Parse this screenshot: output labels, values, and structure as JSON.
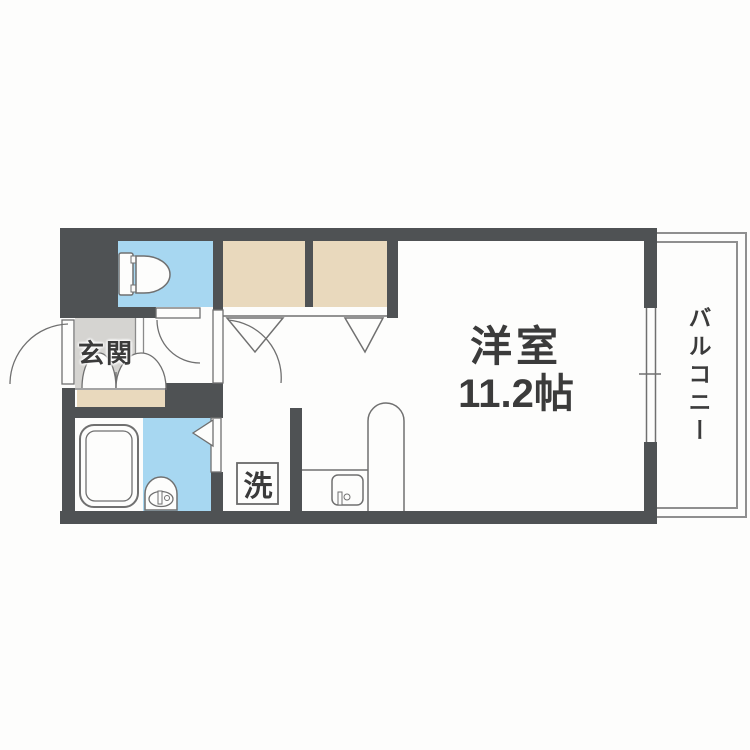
{
  "floorplan": {
    "type": "japanese-apartment-floor-plan",
    "labels": {
      "entrance": "玄関",
      "main_room_name": "洋室",
      "main_room_size": "11.2帖",
      "balcony": "バルコニー",
      "laundry": "洗"
    },
    "colors": {
      "wall": "#4f5254",
      "water_rooms": "#a7d7f1",
      "closet": "#e9d9bd",
      "entrance_floor": "#d5d4d1",
      "outline": "#707070",
      "balcony_outline": "#8f8f8f",
      "text": "#3b3b3b",
      "background": "#fdfdfc"
    },
    "icons": [
      "toilet-icon",
      "bathtub-icon",
      "washbasin-icon",
      "kitchen-sink-icon",
      "kitchen-counter-unit",
      "door-swing-arc",
      "double-entrance-doors",
      "folding-closet-door",
      "sliding-window"
    ]
  }
}
